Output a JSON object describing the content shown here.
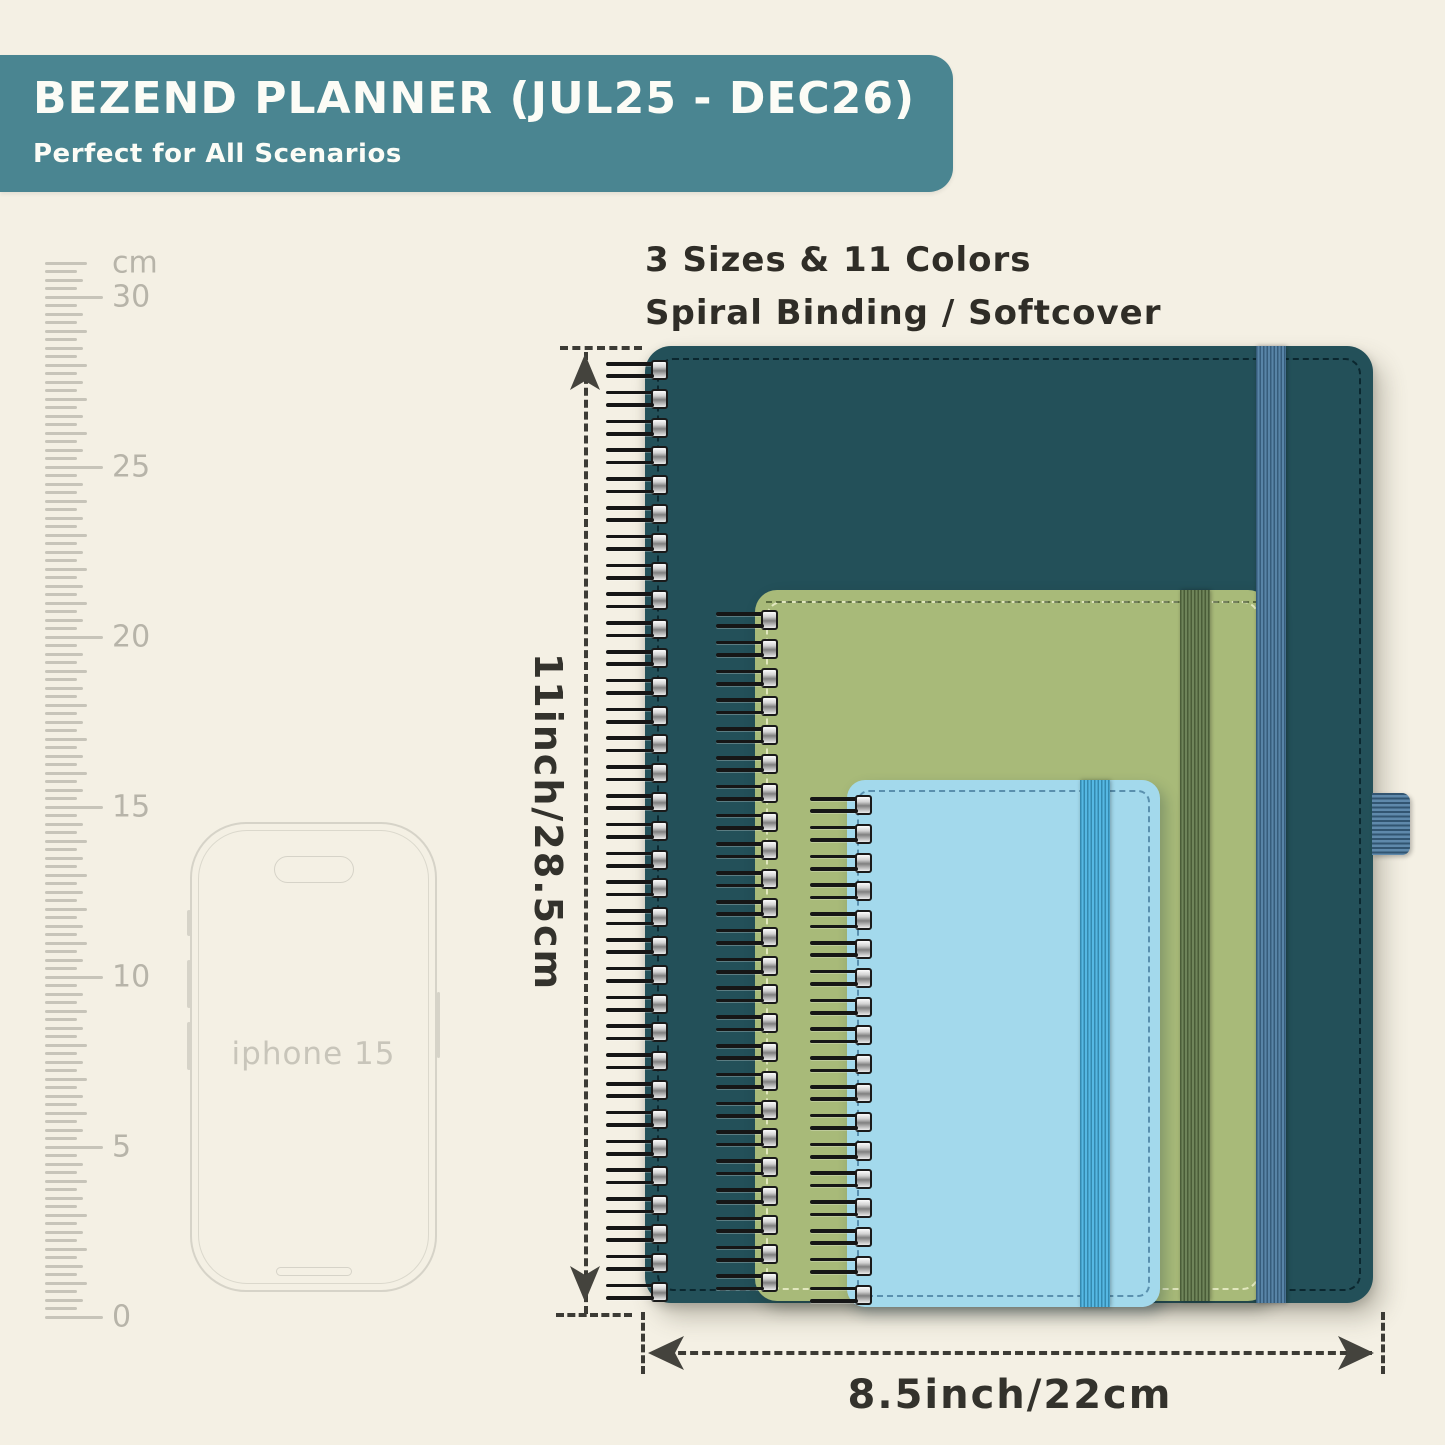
{
  "banner": {
    "title": "BEZEND PLANNER (JUL25 - DEC26)",
    "subtitle": "Perfect for All Scenarios"
  },
  "features": {
    "line1": "3 Sizes & 11 Colors",
    "line2": "Spiral Binding / Softcover"
  },
  "ruler": {
    "unit_label": "cm",
    "labels": [
      "30",
      "25",
      "20",
      "15",
      "10",
      "5",
      "0"
    ]
  },
  "phone": {
    "label": "iphone 15"
  },
  "planners": [
    {
      "id": "large",
      "year_label": "2025-26",
      "icon": "feather-icon",
      "cover_color": "#235059",
      "emboss_color": "#163f49",
      "band_color": "#45769d"
    },
    {
      "id": "medium",
      "year_label": "2025-26",
      "icon": "feather-icon",
      "cover_color": "#a8ba79",
      "emboss_color": "#71802f",
      "band_color": "#5f7647"
    },
    {
      "id": "small",
      "year_label": "2025-26",
      "icon": "feather-icon",
      "cover_color": "#a3d9ec",
      "emboss_color": "#7cb6ca",
      "band_color": "#43b0e0"
    }
  ],
  "dimensions": {
    "height_label": "11inch/28.5cm",
    "width_label": "8.5inch/22cm"
  },
  "colors": {
    "background": "#f4f0e4",
    "banner_bg": "#4a8591",
    "banner_text": "#fcfcf6",
    "body_text": "#2f2d27",
    "dimension": "#44433d",
    "ruler_tick": "#c7c4b9",
    "ruler_label": "#b7b4a9",
    "phone_outline": "#d6d3c8"
  }
}
